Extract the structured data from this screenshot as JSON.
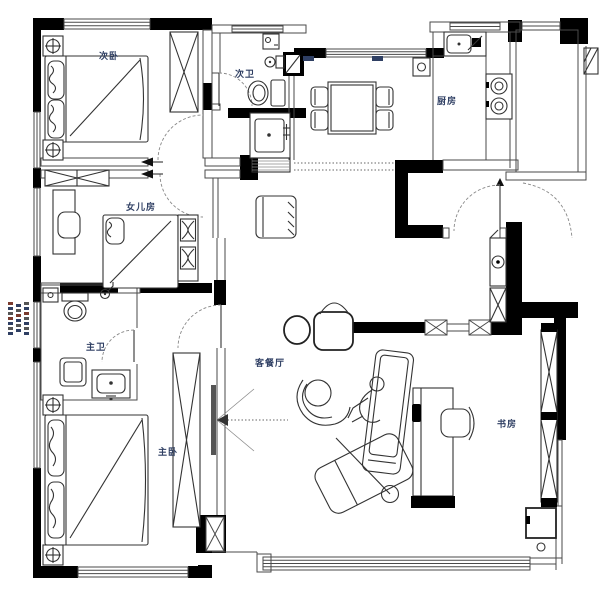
{
  "plan": {
    "rooms": {
      "secondary_bedroom": "次卧",
      "secondary_bathroom": "次卫",
      "kitchen": "厨房",
      "daughters_room": "女儿房",
      "master_bathroom": "主卫",
      "master_bedroom": "主卧",
      "living_dining": "客餐厅",
      "study": "书房"
    },
    "colors": {
      "walls": "#000000",
      "furniture_lines": "#333333",
      "room_labels": "#2f3f63",
      "door_arcs": "#888888",
      "annotation_blue": "#2f3f63",
      "annotation_red": "#7a3b2e",
      "background": "#ffffff"
    }
  }
}
